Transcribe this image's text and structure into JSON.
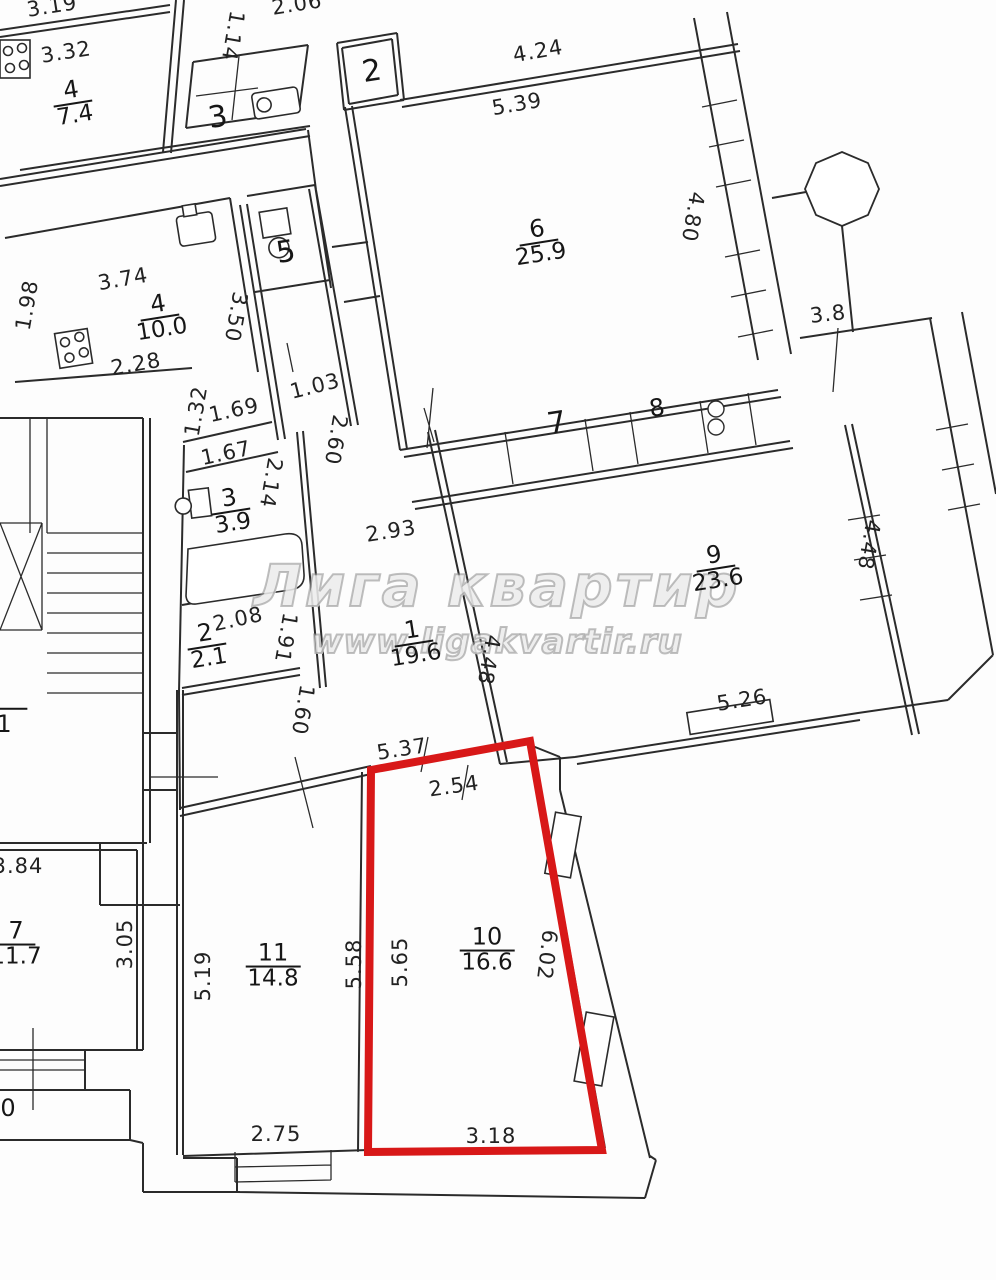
{
  "watermark": {
    "title": "Лига квартир",
    "url": "www.ligakvartir.ru"
  },
  "colors": {
    "highlight": "#d81818",
    "line": "#2b2b2b"
  },
  "rooms": [
    {
      "number": "4",
      "area": "7.4"
    },
    {
      "number": "3",
      "area": ""
    },
    {
      "number": "2",
      "area": ""
    },
    {
      "number": "4",
      "area": "10.0"
    },
    {
      "number": "5",
      "area": ""
    },
    {
      "number": "3",
      "area": "3.9"
    },
    {
      "number": "2",
      "area": "2.1"
    },
    {
      "number": "1",
      "area": "19.6"
    },
    {
      "number": "6",
      "area": "25.9"
    },
    {
      "number": "7",
      "area": ""
    },
    {
      "number": "8",
      "area": ""
    },
    {
      "number": "9",
      "area": "23.6"
    },
    {
      "number": "10",
      "area": "16.6"
    },
    {
      "number": "11",
      "area": "14.8"
    },
    {
      "number": "7",
      "area": "11.7"
    },
    {
      "number": "1",
      "area": ""
    },
    {
      "number": "0",
      "area": ""
    }
  ],
  "dims": [
    "3.19",
    "2.06",
    "1.14",
    "3.32",
    "4.24",
    "5.39",
    "4.80",
    "3.8",
    "3.74",
    "1.98",
    "2.28",
    "3.50",
    "1.03",
    "2.60",
    "1.32",
    "1.69",
    "1.67",
    "2.14",
    "2.93",
    "4.48",
    "2.08",
    "1.91",
    "1.60",
    "4.48",
    "5.26",
    "5.37",
    "2.54",
    "5.58",
    "5.65",
    "6.02",
    "3.18",
    "2.75",
    "5.19",
    "3.05",
    "3.84"
  ]
}
